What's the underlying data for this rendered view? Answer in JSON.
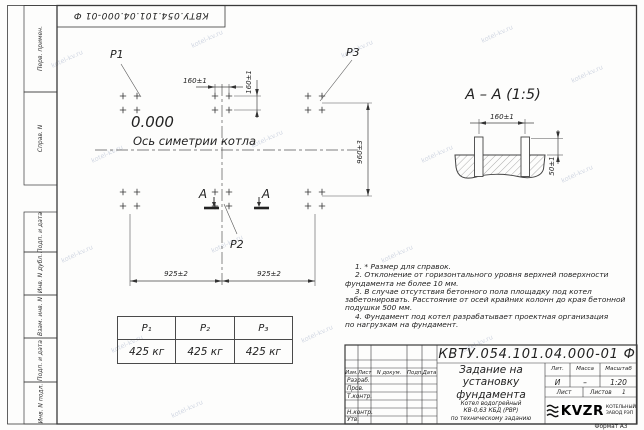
{
  "watermark": "kotel-kv.ru",
  "frame": {
    "stamp_top": "КВТУ.054.101.04.000-01 Ф",
    "strip_labels": [
      "Перв. примен.",
      "Справ. N",
      "Подп. и дата",
      "Инв. N дубл.",
      "Взам. инв. N",
      "Подп. и дата",
      "Инв. N подл."
    ],
    "format_label": "Формат А3"
  },
  "plan": {
    "p1": "P1",
    "p2": "P2",
    "p3": "P3",
    "elevation": "0.000",
    "axis_label": "Ось симетрии котла",
    "section_letter_left": "А",
    "section_letter_right": "А",
    "dim_bolt_x": "160±1",
    "dim_bolt_y": "160±1",
    "dim_span_left": "925±2",
    "dim_span_right": "925±2",
    "dim_rows": "960±3"
  },
  "section": {
    "title": "А – А (1:5)",
    "dim_width": "160±1",
    "dim_height": "50±1"
  },
  "notes": [
    "1. * Размер для справок.",
    "2. Отклонение от горизонтального уровня верхней поверхности\nфундамента не более 10 мм.",
    "3. В случае отсутствия бетонного пола площадку под котел\nзабетонировать. Расстояние от осей крайних колонн до края бетонной\nподушки 500 мм.",
    "4. Фундамент под котел разрабатывает проектная организация\nпо нагрузкам на фундамент."
  ],
  "load_table": {
    "headers": [
      "P₁",
      "P₂",
      "P₃"
    ],
    "values": [
      "425 кг",
      "425 кг",
      "425 кг"
    ]
  },
  "title_block": {
    "designation": "КВТУ.054.101.04.000-01 Ф",
    "doc_title": "Задание на\nустановку\nфундамента",
    "subtitle": "Котел водогрейный\nКВ-0,63 КБД (РВР)\nпо техническому заданию",
    "header_cols": [
      "Изм.",
      "Лист",
      "N докум.",
      "Подп.",
      "Дата"
    ],
    "sign_rows": [
      "Разраб.",
      "Пров.",
      "Т.контр.",
      "Н.контр.",
      "Утв."
    ],
    "lit_headers": [
      "Лит.",
      "Масса",
      "Масштаб"
    ],
    "lit_values": [
      "И",
      "–",
      "1:20"
    ],
    "sheet_label": "Лист",
    "sheets_label": "Листов",
    "sheets_value": "1",
    "company": {
      "logo_text": "KVZR",
      "name": "КОТЕЛЬНЫЙ\nЗАВОД РЭП"
    }
  }
}
